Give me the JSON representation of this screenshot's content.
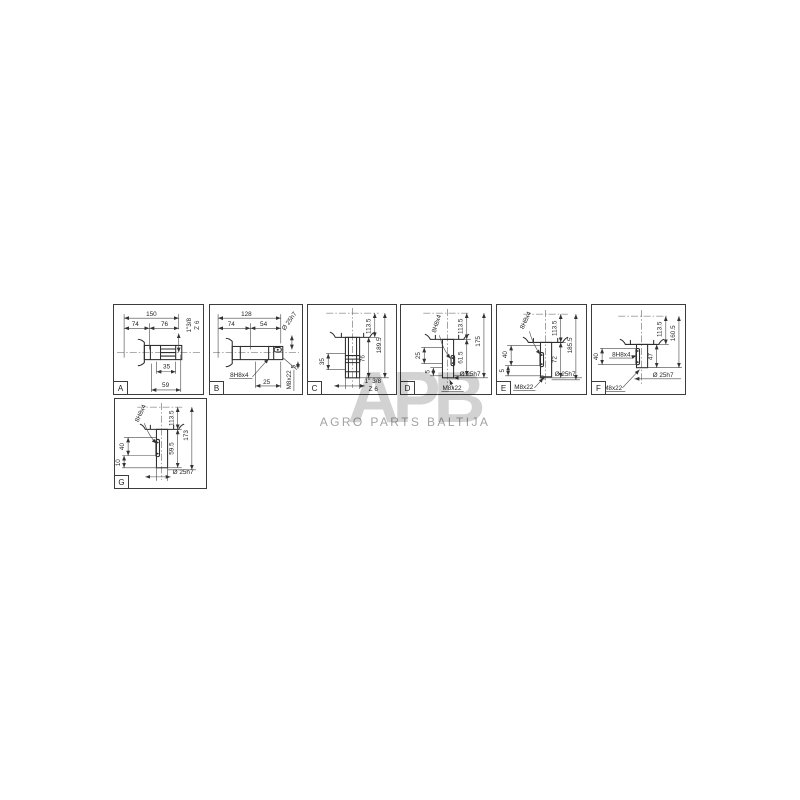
{
  "watermark": {
    "logo": "APB",
    "subtitle": "AGRO PARTS BALTIJA"
  },
  "panels": {
    "a": {
      "letter": "A",
      "len_total": "150",
      "len1": "74",
      "len2": "76",
      "spline": "1\"3/8",
      "teeth": "Z 6",
      "hub": "35",
      "tail": "59"
    },
    "b": {
      "letter": "B",
      "len_total": "128",
      "len1": "74",
      "len2": "54",
      "dia": "Ø 25h7",
      "key": "8H8x4",
      "key_len": "25",
      "chamfer": "5",
      "screw": "M8x22"
    },
    "c": {
      "letter": "C",
      "h1": "113.5",
      "h_total": "189.5",
      "h2": "76",
      "hub": "35",
      "spline": "1\" 3/8",
      "teeth": "Z 6"
    },
    "d": {
      "letter": "D",
      "key": "8H8x4",
      "h1": "113.5",
      "h_total": "175",
      "h2": "61.5",
      "key_len": "25",
      "chamfer": "5",
      "screw": "M8x22",
      "dia": "Ø 25h7"
    },
    "e": {
      "letter": "E",
      "key": "8H8x4",
      "h1": "113.5",
      "h_total": "185.5",
      "h2": "72",
      "key_len": "40",
      "chamfer": "5",
      "dia": "Ø 25h7",
      "screw": "M8x22"
    },
    "f": {
      "letter": "F",
      "key": "8H8x4",
      "h1": "113.5",
      "h_total": "160.5",
      "h2": "47",
      "key_len": "40",
      "dia": "Ø 25h7",
      "screw": "M8x22"
    },
    "g": {
      "letter": "G",
      "key": "8H8x4",
      "h1": "113.5",
      "h_total": "173",
      "h2": "59.5",
      "key_len": "40",
      "tip": "10",
      "dia": "Ø 25h7"
    }
  }
}
